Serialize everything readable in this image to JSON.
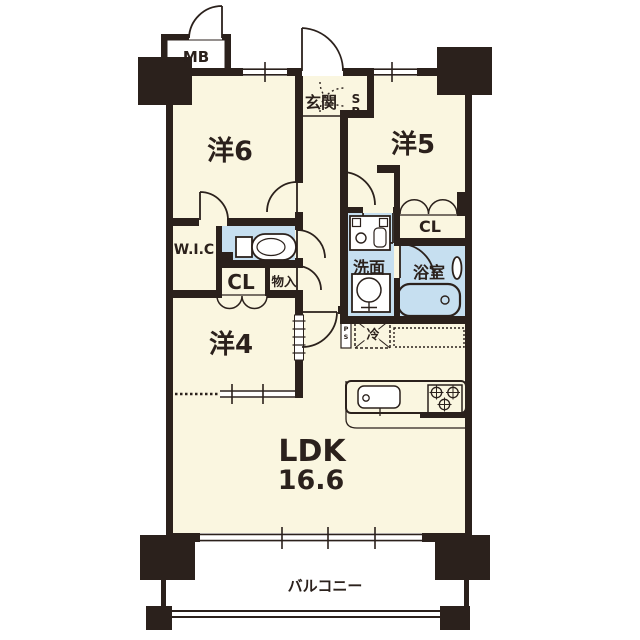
{
  "floorplan": {
    "colors": {
      "wall": "#2b211c",
      "floor": "#faf6e0",
      "wet_area": "#c6dff0",
      "fixture": "#ffffff",
      "background": "#ffffff"
    },
    "labels": {
      "room_west6": "洋6",
      "room_west5": "洋5",
      "room_west4": "洋4",
      "ldk": "LDK",
      "ldk_size": "16.6",
      "entrance": "玄関",
      "shoe_box": [
        "S",
        "B"
      ],
      "meter_box": "MB",
      "walk_in_closet": "W.I.C",
      "closet_west4": "CL",
      "closet_west5": "CL",
      "storage": "物入",
      "washroom": "洗面",
      "bathroom": "浴室",
      "refrigerator": "冷",
      "pipe_space": "PS",
      "pipe_space_vertical": [
        "P",
        "S"
      ],
      "balcony": "バルコニー"
    }
  }
}
